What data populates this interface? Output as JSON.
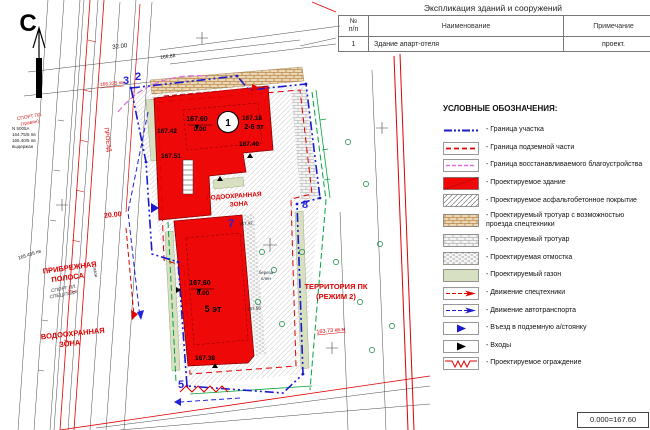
{
  "sheet": {
    "table": {
      "title": "Экспликация зданий и сооружений",
      "col_num": "№ п/п",
      "col_name": "Наименование",
      "col_note": "Примечание",
      "row_num": "1",
      "row_name": "Здание апарт-отеля",
      "row_note": "проект."
    },
    "legend": {
      "title": "УСЛОВНЫЕ ОБОЗНАЧЕНИЯ:",
      "items": [
        {
          "symbol": "parcel-boundary-line",
          "label": "- Граница участка"
        },
        {
          "symbol": "underground-boundary-line",
          "label": "- Граница подземной части"
        },
        {
          "symbol": "restored-landscaping-boundary",
          "label": "- Граница восстанавливаемого благоустройства"
        },
        {
          "symbol": "designed-building",
          "label": "- Проектируемое здание"
        },
        {
          "symbol": "asphalt-pavement",
          "label": "- Проектируемое асфальтобетонное покрытие"
        },
        {
          "symbol": "sidewalk-for-service-vehicles",
          "label": "- Проектируемый тротуар с возможностью проезда спецтехники"
        },
        {
          "symbol": "designed-sidewalk",
          "label": "- Проектируемый тротуар"
        },
        {
          "symbol": "designed-blind-area",
          "label": "- Проектируемая отмостка"
        },
        {
          "symbol": "designed-lawn",
          "label": "- Проектируемый газон"
        },
        {
          "symbol": "service-vehicle-traffic",
          "label": "- Движение спецтехники"
        },
        {
          "symbol": "auto-traffic",
          "label": "- Движение автотранспорта"
        },
        {
          "symbol": "underground-parking-entry",
          "label": "- Въезд в подземную а/стоянку"
        },
        {
          "symbol": "entrances",
          "label": "- Входы"
        },
        {
          "symbol": "designed-fence",
          "label": "- Проектируемое ограждение"
        }
      ]
    },
    "elevation_mark": "0.000=167.60"
  },
  "map": {
    "north": "С",
    "zones": {
      "coastal": [
        "ПРИБРЕЖНАЯ",
        "ПОЛОСА"
      ],
      "water_left": [
        "ВОДООХРАННАЯ",
        "ЗОНА"
      ],
      "water_mid": [
        "ВОДООХРАННАЯ",
        "ЗОНА"
      ],
      "pk": [
        "ТЕРРИТОРИЯ ПК",
        "(РЕЖИМ 2)"
      ]
    },
    "buildings": {
      "upper": {
        "number": "1",
        "elev_top": "167.60",
        "elev_zero": "0.00",
        "mark_ne": "167.18",
        "floors": "2-6 эт",
        "mark_w": "167.42",
        "mark_e": "167.40",
        "mark_sw": "167.51"
      },
      "lower": {
        "elev_top": "167.60",
        "elev_zero": "0.00",
        "floors": "5 эт",
        "mark_s": "167.38"
      }
    },
    "points": {
      "p2": "2",
      "p3": "3",
      "p5": "5",
      "p7": "7",
      "p8": "8"
    },
    "annotations": {
      "proezd": "ПРОЕЗД",
      "dim20": "20.00",
      "dim32": "32.00",
      "sport1a": "СПОРТ ПЛ.",
      "sport1b": "(травян)",
      "sport2a": "СПОРТ ПЛ.",
      "sport2b": "СПЕЦ.ПОКР.",
      "lawn": "газон",
      "area": "163.73 кв.м",
      "lvl1": "165.495 пв",
      "lvl2": "166.225 пв",
      "pt_name": "N 5005А",
      "pt_l1": "164.75/5 пв",
      "pt_l2": "165.40/5 пв",
      "pt_l3": "выдержан",
      "e1": "166.88",
      "e2": "167.58",
      "e3": "167.42",
      "tree1": "береза",
      "tree2": "клен"
    }
  },
  "colors": {
    "building_red": "#ee0808",
    "boundary_blue": "#1a1acc",
    "underground_red": "#e00000",
    "restored_magenta": "#e06ae0",
    "green_line": "#00a33c",
    "lawn_fill": "#d7e0c0",
    "brick_tan": "#a06828",
    "zone_text_red": "#dd0000"
  }
}
